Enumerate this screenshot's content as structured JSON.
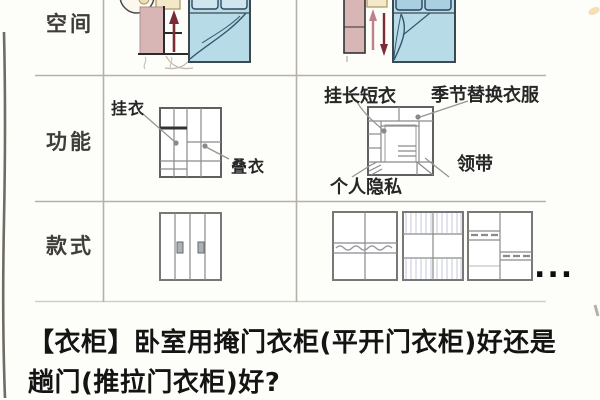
{
  "colors": {
    "wardrobe_pink": "#d9b6b6",
    "bed_blue": "#b7dbe7",
    "pillow_blue": "#a9cfe0",
    "arrow_red": "#7a2b33",
    "arrow_pink": "#bb8289",
    "table_line": "#b5b1a9",
    "text_dark": "#141414"
  },
  "rows": {
    "space": "空间",
    "function": "功能",
    "style": "款式"
  },
  "annotations": {
    "hinged": {
      "hang": "挂衣",
      "fold": "叠衣"
    },
    "sliding": {
      "hang_long_short": "挂长短衣",
      "seasonal": "季节替换衣服",
      "tie": "领带",
      "privacy": "个人隐私"
    }
  },
  "style_row": {
    "more": "..."
  },
  "title": {
    "line1": "【衣柜】卧室用掩门衣柜(平开门衣柜)好还是",
    "line2": "趟门(推拉门衣柜)好?"
  }
}
